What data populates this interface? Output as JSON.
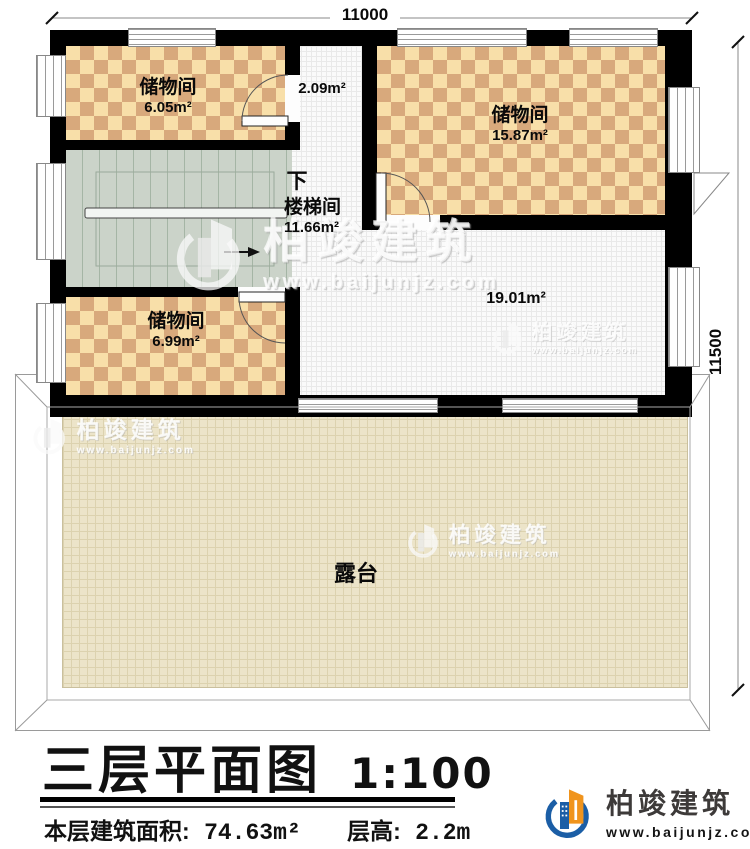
{
  "plan": {
    "dim_top": "11000",
    "dim_right": "11500",
    "rooms": {
      "storage_a": {
        "name": "储物间",
        "area": "6.05m²"
      },
      "hall": {
        "area": "2.09m²"
      },
      "storage_b": {
        "name": "储物间",
        "area": "15.87m²"
      },
      "stair": {
        "down_label": "下",
        "name": "楼梯间",
        "area": "11.66m²"
      },
      "storage_c": {
        "name": "储物间",
        "area": "6.99m²"
      },
      "open": {
        "area": "19.01m²"
      },
      "terrace": {
        "name": "露台"
      }
    }
  },
  "titleblock": {
    "title": "三层平面图",
    "scale": "1:100",
    "floor_area_label": "本层建筑面积:",
    "floor_area_value": "74.63m²",
    "floor_height_label": "层高:",
    "floor_height_value": "2.2m"
  },
  "brand": {
    "name": "柏竣建筑",
    "url": "www.baijunjz.com"
  },
  "watermark": {
    "name": "柏竣建筑",
    "url": "www.baijunjz.com"
  },
  "colors": {
    "wall": "#000000",
    "checker_light": "#f8dfa9",
    "checker_dark": "#d8a97c",
    "stair": "#cbd3c9",
    "terrace": "#ece4c9",
    "brand_blue": "#1b5ea6",
    "brand_orange": "#f0941d"
  }
}
